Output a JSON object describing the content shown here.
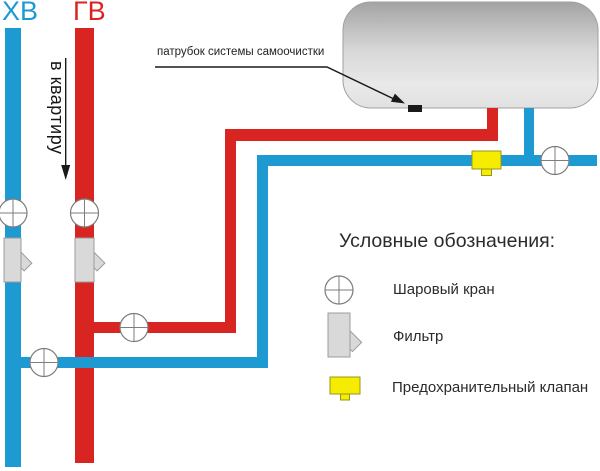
{
  "colors": {
    "cold": "#1e9ad3",
    "hot": "#d92522",
    "valve_yellow": "#f6ec00",
    "filter_gray": "#d9d9d9",
    "ink": "#1a1a1a"
  },
  "pipes": {
    "cold_label": "ХВ",
    "hot_label": "ГВ",
    "direction_label": "в квартиру"
  },
  "annotations": {
    "spigot_label": "патрубок системы самоочистки"
  },
  "legend": {
    "title": "Условные обозначения:",
    "items": [
      {
        "symbol": "ball-valve",
        "label": "Шаровый кран"
      },
      {
        "symbol": "filter",
        "label": "Фильтр"
      },
      {
        "symbol": "safety-valve",
        "label": "Предохранительный клапан"
      }
    ]
  }
}
